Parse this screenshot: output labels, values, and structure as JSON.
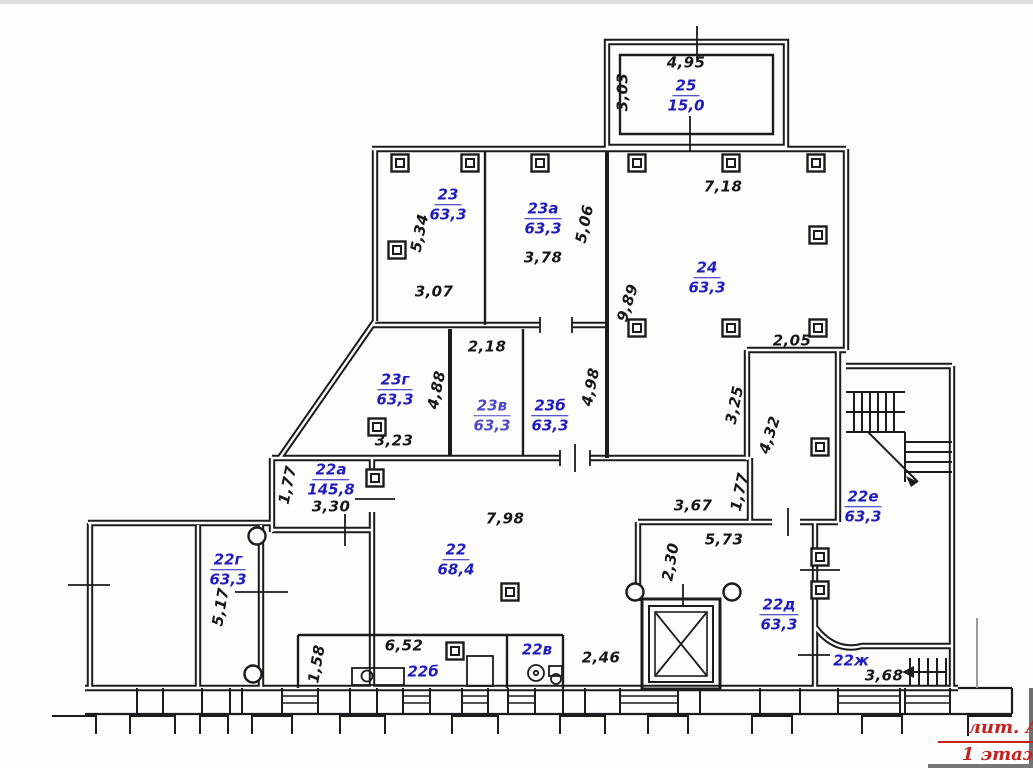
{
  "document": {
    "type": "floor plan scan",
    "annotation": {
      "litera": "лит. А",
      "floor": "1 этаж"
    }
  },
  "colors": {
    "room_label": "#1f1cbe",
    "dimension": "#161616",
    "annotation": "#c32020",
    "walls": "#1c1c1c",
    "background": "#fdfdfc"
  },
  "rooms": [
    {
      "number": "25",
      "area": "15,0"
    },
    {
      "number": "23",
      "area": "63,3"
    },
    {
      "number": "23а",
      "area": "63,3"
    },
    {
      "number": "24",
      "area": "63,3"
    },
    {
      "number": "23г",
      "area": "63,3"
    },
    {
      "number": "23в",
      "area": "63,3"
    },
    {
      "number": "23б",
      "area": "63,3"
    },
    {
      "number": "22а",
      "area": "145,8"
    },
    {
      "number": "22",
      "area": "68,4"
    },
    {
      "number": "22г",
      "area": "63,3"
    },
    {
      "number": "22е",
      "area": "63,3"
    },
    {
      "number": "22д",
      "area": "63,3"
    },
    {
      "number": "22б"
    },
    {
      "number": "22в"
    },
    {
      "number": "22ж"
    }
  ],
  "dimensions": [
    {
      "value": "4,95"
    },
    {
      "value": "3,03"
    },
    {
      "value": "7,18"
    },
    {
      "value": "5,34"
    },
    {
      "value": "3,78"
    },
    {
      "value": "5,06"
    },
    {
      "value": "3,07"
    },
    {
      "value": "9,89"
    },
    {
      "value": "2,05"
    },
    {
      "value": "2,18"
    },
    {
      "value": "4,88"
    },
    {
      "value": "4,98"
    },
    {
      "value": "3,25"
    },
    {
      "value": "4,32"
    },
    {
      "value": "3,23"
    },
    {
      "value": "1,77"
    },
    {
      "value": "3,30"
    },
    {
      "value": "7,98"
    },
    {
      "value": "3,67"
    },
    {
      "value": "1,77"
    },
    {
      "value": "5,73"
    },
    {
      "value": "2,30"
    },
    {
      "value": "5,17"
    },
    {
      "value": "6,52"
    },
    {
      "value": "1,58"
    },
    {
      "value": "2,46"
    },
    {
      "value": "3,68"
    }
  ]
}
